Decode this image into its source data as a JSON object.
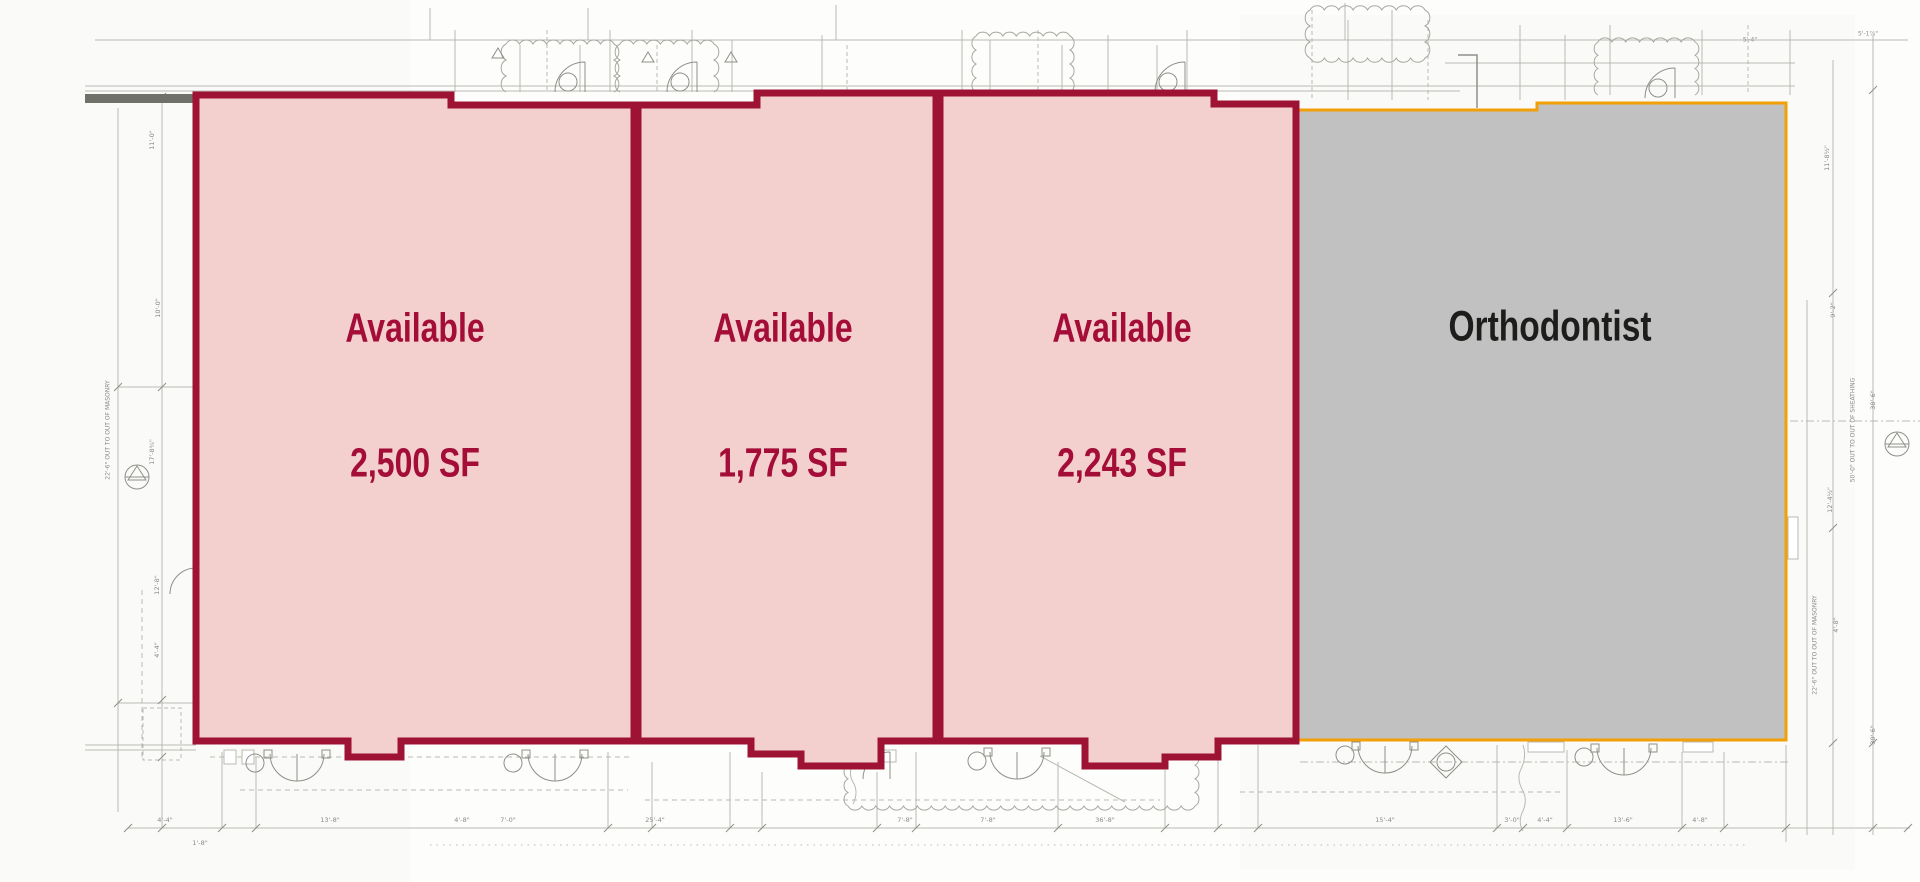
{
  "suites": [
    {
      "name": "Suite 1",
      "status": "Available",
      "area": "2,500 SF"
    },
    {
      "name": "Suite 2",
      "status": "Available",
      "area": "1,775 SF"
    },
    {
      "name": "Suite 3",
      "status": "Available",
      "area": "2,243 SF"
    },
    {
      "name": "Suite 4",
      "tenant": "Orthodontist"
    }
  ],
  "colors": {
    "available_fill": "#f3cfce",
    "available_border": "#9e1233",
    "available_text": "#a30d37",
    "leased_fill": "#c1c1c1",
    "leased_border": "#f2a007",
    "leased_text": "#1d1d1b",
    "plan_line": "#b9b9b3",
    "plan_dark": "#8f8f8a",
    "wall_bar": "#70706b"
  },
  "annotations": {
    "labels": [
      {
        "t": "4'-4\"",
        "x": 165,
        "y": 820,
        "r": 0
      },
      {
        "t": "13'-8\"",
        "x": 330,
        "y": 820,
        "r": 0
      },
      {
        "t": "4'-8\"",
        "x": 462,
        "y": 820,
        "r": 0
      },
      {
        "t": "7'-0\"",
        "x": 508,
        "y": 820,
        "r": 0
      },
      {
        "t": "25'-4\"",
        "x": 655,
        "y": 820,
        "r": 0
      },
      {
        "t": "7'-8\"",
        "x": 905,
        "y": 820,
        "r": 0
      },
      {
        "t": "7'-8\"",
        "x": 988,
        "y": 820,
        "r": 0
      },
      {
        "t": "36'-8\"",
        "x": 1105,
        "y": 820,
        "r": 0
      },
      {
        "t": "15'-4\"",
        "x": 1385,
        "y": 820,
        "r": 0
      },
      {
        "t": "3'-0\"",
        "x": 1512,
        "y": 820,
        "r": 0
      },
      {
        "t": "4'-4\"",
        "x": 1545,
        "y": 820,
        "r": 0
      },
      {
        "t": "13'-6\"",
        "x": 1623,
        "y": 820,
        "r": 0
      },
      {
        "t": "4'-8\"",
        "x": 1700,
        "y": 820,
        "r": 0
      },
      {
        "t": "1'-8\"",
        "x": 200,
        "y": 843,
        "r": 0
      },
      {
        "t": "11'-0\"",
        "x": 152,
        "y": 140,
        "r": -90
      },
      {
        "t": "10'-0\"",
        "x": 158,
        "y": 308,
        "r": -90
      },
      {
        "t": "17'-8¾\"",
        "x": 152,
        "y": 452,
        "r": -90
      },
      {
        "t": "12'-8\"",
        "x": 157,
        "y": 585,
        "r": -90
      },
      {
        "t": "4'-4\"",
        "x": 157,
        "y": 650,
        "r": -90
      },
      {
        "t": "22'-6\" OUT TO OUT OF MASONRY",
        "x": 108,
        "y": 430,
        "r": -90,
        "s": 6
      },
      {
        "t": "11'-8½\"",
        "x": 1827,
        "y": 158,
        "r": -90
      },
      {
        "t": "9'-2\"",
        "x": 1833,
        "y": 310,
        "r": -90
      },
      {
        "t": "38'-6\"",
        "x": 1873,
        "y": 400,
        "r": -90
      },
      {
        "t": "12'-4½\"",
        "x": 1830,
        "y": 500,
        "r": -90
      },
      {
        "t": "4'-8\"",
        "x": 1836,
        "y": 625,
        "r": -90
      },
      {
        "t": "30'-6\"",
        "x": 1873,
        "y": 735,
        "r": -90
      },
      {
        "t": "50'-0\" OUT TO OUT OF SHEATHING",
        "x": 1853,
        "y": 430,
        "r": -90,
        "s": 6
      },
      {
        "t": "22'-6\" OUT TO OUT OF MASONRY",
        "x": 1815,
        "y": 645,
        "r": -90,
        "s": 6
      },
      {
        "t": "5'-4\"",
        "x": 1750,
        "y": 40,
        "r": 0,
        "s": 6
      },
      {
        "t": "5'-1⅞\"",
        "x": 1868,
        "y": 34,
        "r": 0,
        "s": 6
      }
    ]
  }
}
